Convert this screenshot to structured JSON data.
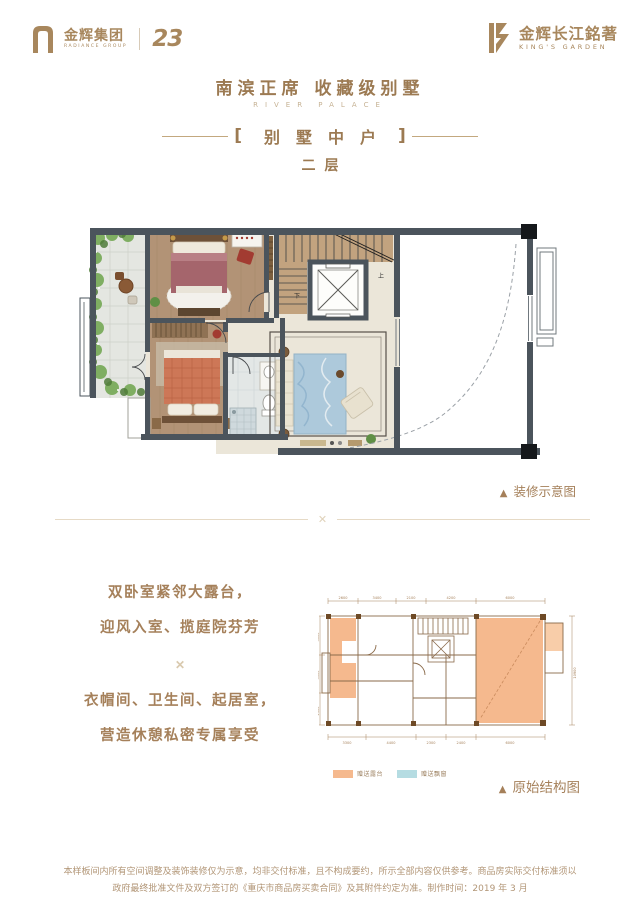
{
  "colors": {
    "gold": "#a8875d",
    "title_gold": "#9c7a52",
    "rule_beige": "#e6dac6",
    "wall_dark": "#4b545c",
    "wood": "#b29376",
    "legend_orange": "#f5b98e",
    "legend_blue": "#b5dce2"
  },
  "header": {
    "left_logo": {
      "cn": "金辉集团",
      "en": "RADIANCE GROUP",
      "anniversary": "23"
    },
    "right_logo": {
      "cn": "金辉长江銘著",
      "en": "KING'S GARDEN"
    }
  },
  "hero": {
    "title": "南滨正席 收藏级别墅",
    "subtitle_en": "RIVER PALACE",
    "bracket_left": "[",
    "unit": "别墅中户",
    "bracket_right": "]",
    "floor": "二层"
  },
  "plan": {
    "triangle": "▲",
    "caption_decorated": "装修示意图",
    "caption_structural": "原始结构图",
    "stair_up": "上",
    "stair_down": "下"
  },
  "features": {
    "line1": "双卧室紧邻大露台，",
    "line2": "迎风入室、揽庭院芬芳",
    "divider_ornament": "✕",
    "line3": "衣帽间、卫生间、起居室，",
    "line4": "营造休憩私密专属享受"
  },
  "structural": {
    "legend": [
      {
        "label": "赠送露台",
        "color": "#f5b98e"
      },
      {
        "label": "赠送飘窗",
        "color": "#b5dce2"
      }
    ],
    "dims_top": [
      "2600",
      "3400",
      "2100",
      "4200",
      "6000"
    ],
    "dims_bottom": [
      "3300",
      "4400",
      "2300",
      "2400",
      "6000"
    ],
    "dims_left": [
      "3600",
      "3300",
      "2900"
    ],
    "dims_right": [
      "10900"
    ]
  },
  "footer": {
    "line1": "本样板间内所有空间调整及装饰装修仅为示意，均非交付标准，且不构成要约，所示全部内容仅供参考。商品房实际交付标准须以",
    "line2": "政府最终批准文件及双方签订的《重庆市商品房买卖合同》及其附件约定为准。制作时间：2019 年 3 月"
  }
}
